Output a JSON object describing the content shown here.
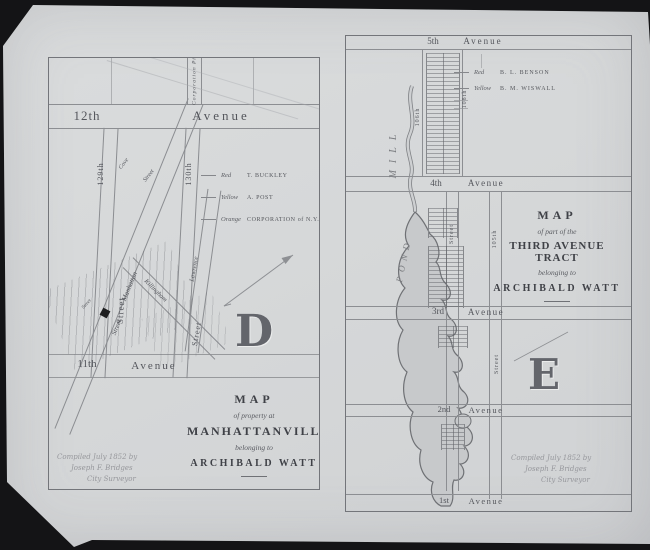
{
  "palette": {
    "backdrop": "#141416",
    "paper": "#d7d9da",
    "ink": "#56585e"
  },
  "left_map": {
    "plate_letter": "D",
    "labels": {
      "corporation_pier": "Corporation Pier",
      "ave12_num": "12th",
      "ave12_word": "Avenue",
      "st129": "129th",
      "st130": "130th",
      "cove": "Cove",
      "street": "Street",
      "manhattan": "Manhattan",
      "killingham": "Killingham",
      "lawrence": "Lawrence",
      "ave11_num": "11th",
      "ave11_word": "Avenue"
    },
    "legend": {
      "entries": [
        {
          "color_name": "Red",
          "owner": "T. BUCKLEY"
        },
        {
          "color_name": "Yellow",
          "owner": "A. POST"
        },
        {
          "color_name": "Orange",
          "owner": "CORPORATION of N.Y."
        }
      ]
    },
    "title": {
      "word_map": "MAP",
      "sub1": "of property at",
      "name": "MANHATTANVILLE",
      "sub2": "belonging to",
      "owner": "ARCHIBALD WATT"
    },
    "credit": {
      "line1": "Compiled July 1852 by",
      "line2": "Joseph F. Bridges",
      "line3": "City Surveyor"
    }
  },
  "right_map": {
    "plate_letter": "E",
    "labels": {
      "ave5_num": "5th",
      "ave5_word": "Avenue",
      "ave4_num": "4th",
      "ave4_word": "Avenue",
      "ave3_num": "3rd",
      "ave3_word": "Avenue",
      "ave2_num": "2nd",
      "ave2_word": "Avenue",
      "ave1_num": "1st",
      "ave1_word": "Avenue",
      "st106": "106th",
      "st108": "108th",
      "st105": "105th",
      "street": "Street",
      "mill": "MILL",
      "pond": "POND"
    },
    "legend": {
      "entries": [
        {
          "color_name": "Red",
          "owner": "B. L. BENSON"
        },
        {
          "color_name": "Yellow",
          "owner": "B. M. WISWALL"
        }
      ]
    },
    "title": {
      "word_map": "MAP",
      "sub1": "of part of the",
      "name": "THIRD AVENUE TRACT",
      "sub2": "belonging to",
      "owner": "ARCHIBALD WATT"
    },
    "credit": {
      "line1": "Compiled July 1852 by",
      "line2": "Joseph F. Bridges",
      "line3": "City Surveyor"
    }
  }
}
